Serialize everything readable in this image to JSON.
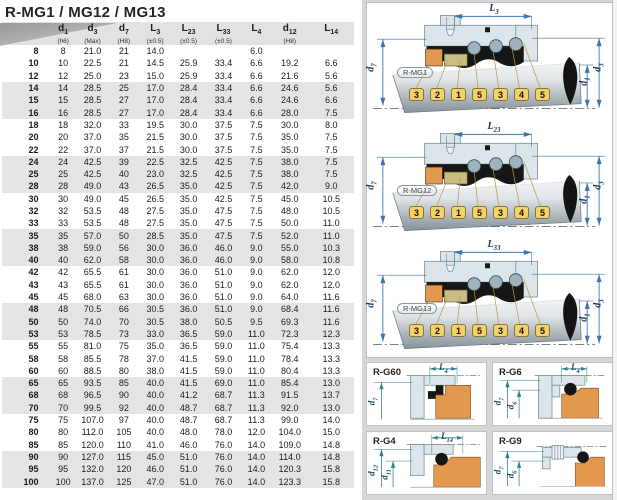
{
  "title": "R-MG1 / MG12 / MG13",
  "colors": {
    "dim_blue": "#3f74b3",
    "dim_teal": "#2b8094",
    "tag_yellow": "#f3d26a",
    "part_orange": "#e2984f",
    "part_olive": "#c9bd85",
    "housing_gray_blue": "#dce6ea",
    "row_band_gray": "#e4e4e4"
  },
  "table": {
    "headers": [
      {
        "sym": "",
        "sub": "",
        "tol": ""
      },
      {
        "sym": "d",
        "sub": "1",
        "tol": "(h6)"
      },
      {
        "sym": "d",
        "sub": "3",
        "tol": "(Max)"
      },
      {
        "sym": "d",
        "sub": "7",
        "tol": "(H8)"
      },
      {
        "sym": "L",
        "sub": "3",
        "tol": "(±0.5)"
      },
      {
        "sym": "L",
        "sub": "23",
        "tol": "(±0.5)"
      },
      {
        "sym": "L",
        "sub": "33",
        "tol": "(±0.5)"
      },
      {
        "sym": "L",
        "sub": "4",
        "tol": ""
      },
      {
        "sym": "d",
        "sub": "12",
        "tol": "(H8)"
      },
      {
        "sym": "L",
        "sub": "14",
        "tol": ""
      }
    ],
    "rows": [
      [
        "8",
        "8",
        "21.0",
        "21",
        "14.0",
        "",
        "",
        "6.0",
        "",
        ""
      ],
      [
        "10",
        "10",
        "22.5",
        "21",
        "14.5",
        "25.9",
        "33.4",
        "6.6",
        "19.2",
        "6.6"
      ],
      [
        "12",
        "12",
        "25.0",
        "23",
        "15.0",
        "25.9",
        "33.4",
        "6.6",
        "21.6",
        "5.6"
      ],
      [
        "14",
        "14",
        "28.5",
        "25",
        "17.0",
        "28.4",
        "33.4",
        "6.6",
        "24.6",
        "5.6"
      ],
      [
        "15",
        "15",
        "28.5",
        "27",
        "17.0",
        "28.4",
        "33.4",
        "6.6",
        "24.6",
        "6.6"
      ],
      [
        "16",
        "16",
        "28.5",
        "27",
        "17.0",
        "28.4",
        "33.4",
        "6.6",
        "28.0",
        "7.5"
      ],
      [
        "18",
        "18",
        "32.0",
        "33",
        "19.5",
        "30.0",
        "37.5",
        "7.5",
        "30.0",
        "8.0"
      ],
      [
        "20",
        "20",
        "37.0",
        "35",
        "21.5",
        "30.0",
        "37.5",
        "7.5",
        "35.0",
        "7.5"
      ],
      [
        "22",
        "22",
        "37.0",
        "37",
        "21.5",
        "30.0",
        "37.5",
        "7.5",
        "35.0",
        "7.5"
      ],
      [
        "24",
        "24",
        "42.5",
        "39",
        "22.5",
        "32.5",
        "42.5",
        "7.5",
        "38.0",
        "7.5"
      ],
      [
        "25",
        "25",
        "42.5",
        "40",
        "23.0",
        "32.5",
        "42.5",
        "7.5",
        "38.0",
        "7.5"
      ],
      [
        "28",
        "28",
        "49.0",
        "43",
        "26.5",
        "35.0",
        "42.5",
        "7.5",
        "42.0",
        "9.0"
      ],
      [
        "30",
        "30",
        "49.0",
        "45",
        "26.5",
        "35.0",
        "42.5",
        "7.5",
        "45.0",
        "10.5"
      ],
      [
        "32",
        "32",
        "53.5",
        "48",
        "27.5",
        "35.0",
        "47.5",
        "7.5",
        "48.0",
        "10.5"
      ],
      [
        "33",
        "33",
        "53.5",
        "48",
        "27.5",
        "35.0",
        "47.5",
        "7.5",
        "50.0",
        "11.0"
      ],
      [
        "35",
        "35",
        "57.0",
        "50",
        "28.5",
        "35.0",
        "47.5",
        "7.5",
        "52.0",
        "11.0"
      ],
      [
        "38",
        "38",
        "59.0",
        "56",
        "30.0",
        "36.0",
        "46.0",
        "9.0",
        "55.0",
        "10.3"
      ],
      [
        "40",
        "40",
        "62.0",
        "58",
        "30.0",
        "36.0",
        "46.0",
        "9.0",
        "58.0",
        "10.8"
      ],
      [
        "42",
        "42",
        "65.5",
        "61",
        "30.0",
        "36.0",
        "51.0",
        "9.0",
        "62.0",
        "12.0"
      ],
      [
        "43",
        "43",
        "65.5",
        "61",
        "30.0",
        "36.0",
        "51.0",
        "9.0",
        "62.0",
        "12.0"
      ],
      [
        "45",
        "45",
        "68.0",
        "63",
        "30.0",
        "36.0",
        "51.0",
        "9.0",
        "64.0",
        "11.6"
      ],
      [
        "48",
        "48",
        "70.5",
        "66",
        "30.5",
        "36.0",
        "51.0",
        "9.0",
        "68.4",
        "11.6"
      ],
      [
        "50",
        "50",
        "74.0",
        "70",
        "30.5",
        "38.0",
        "50.5",
        "9.5",
        "69.3",
        "11.6"
      ],
      [
        "53",
        "53",
        "78.5",
        "73",
        "33.0",
        "36.5",
        "59.0",
        "11.0",
        "72.3",
        "12.3"
      ],
      [
        "55",
        "55",
        "81.0",
        "75",
        "35.0",
        "36.5",
        "59.0",
        "11.0",
        "75.4",
        "13.3"
      ],
      [
        "58",
        "58",
        "85.5",
        "78",
        "37.0",
        "41.5",
        "59.0",
        "11.0",
        "78.4",
        "13.3"
      ],
      [
        "60",
        "60",
        "88.5",
        "80",
        "38.0",
        "41.5",
        "59.0",
        "11.0",
        "80.4",
        "13.3"
      ],
      [
        "65",
        "65",
        "93.5",
        "85",
        "40.0",
        "41.5",
        "69.0",
        "11.0",
        "85.4",
        "13.0"
      ],
      [
        "68",
        "68",
        "96.5",
        "90",
        "40.0",
        "41.2",
        "68.7",
        "11.3",
        "91.5",
        "13.7"
      ],
      [
        "70",
        "70",
        "99.5",
        "92",
        "40.0",
        "48.7",
        "68.7",
        "11.3",
        "92.0",
        "13.0"
      ],
      [
        "75",
        "75",
        "107.0",
        "97",
        "40.0",
        "48.7",
        "68.7",
        "11.3",
        "99.0",
        "14.0"
      ],
      [
        "80",
        "80",
        "112.0",
        "105",
        "40.0",
        "48.0",
        "78.0",
        "12.0",
        "104.0",
        "15.0"
      ],
      [
        "85",
        "85",
        "120.0",
        "110",
        "41.0",
        "46.0",
        "76.0",
        "14.0",
        "109.0",
        "14.8"
      ],
      [
        "90",
        "90",
        "127.0",
        "115",
        "45.0",
        "51.0",
        "76.0",
        "14.0",
        "114.0",
        "14.8"
      ],
      [
        "95",
        "95",
        "132.0",
        "120",
        "46.0",
        "51.0",
        "76.0",
        "14.0",
        "120.3",
        "15.8"
      ],
      [
        "100",
        "100",
        "137.0",
        "125",
        "47.0",
        "51.0",
        "76.0",
        "14.0",
        "123.3",
        "15.8"
      ]
    ]
  },
  "diagrams": [
    {
      "label": "R-MG1",
      "dim_top": {
        "sym": "L",
        "sub": "3"
      },
      "dim_left": {
        "sym": "d",
        "sub": "7"
      },
      "dims_right": [
        {
          "sym": "d",
          "sub": "1"
        },
        {
          "sym": "d",
          "sub": "3"
        }
      ],
      "part_numbers": [
        "3",
        "2",
        "1",
        "5",
        "3",
        "4",
        "5"
      ]
    },
    {
      "label": "R-MG12",
      "dim_top": {
        "sym": "L",
        "sub": "23"
      },
      "dim_left": {
        "sym": "d",
        "sub": "7"
      },
      "dims_right": [
        {
          "sym": "d",
          "sub": "1"
        },
        {
          "sym": "d",
          "sub": "3"
        }
      ],
      "part_numbers": [
        "3",
        "2",
        "1",
        "5",
        "3",
        "4",
        "5"
      ]
    },
    {
      "label": "R-MG13",
      "dim_top": {
        "sym": "L",
        "sub": "33"
      },
      "dim_left": {
        "sym": "d",
        "sub": "7"
      },
      "dims_right": [
        {
          "sym": "d",
          "sub": "1"
        },
        {
          "sym": "d",
          "sub": "3"
        }
      ],
      "part_numbers": [
        "3",
        "2",
        "1",
        "5",
        "3",
        "4",
        "5"
      ]
    }
  ],
  "detail_diagrams": [
    {
      "label": "R-G60",
      "dim_top": {
        "sym": "L",
        "sub": "4"
      },
      "dims_left": [
        {
          "sym": "d",
          "sub": "7"
        }
      ]
    },
    {
      "label": "R-G6",
      "dim_top": {
        "sym": "L",
        "sub": "4"
      },
      "dims_left": [
        {
          "sym": "d",
          "sub": "7"
        },
        {
          "sym": "d",
          "sub": "6"
        }
      ]
    },
    {
      "label": "R-G4",
      "dim_top": {
        "sym": "L",
        "sub": "14"
      },
      "dims_left": [
        {
          "sym": "d",
          "sub": "12"
        },
        {
          "sym": "d",
          "sub": "11"
        }
      ]
    },
    {
      "label": "R-G9",
      "dims_left": [
        {
          "sym": "d",
          "sub": "7"
        },
        {
          "sym": "d",
          "sub": "6"
        }
      ]
    }
  ]
}
